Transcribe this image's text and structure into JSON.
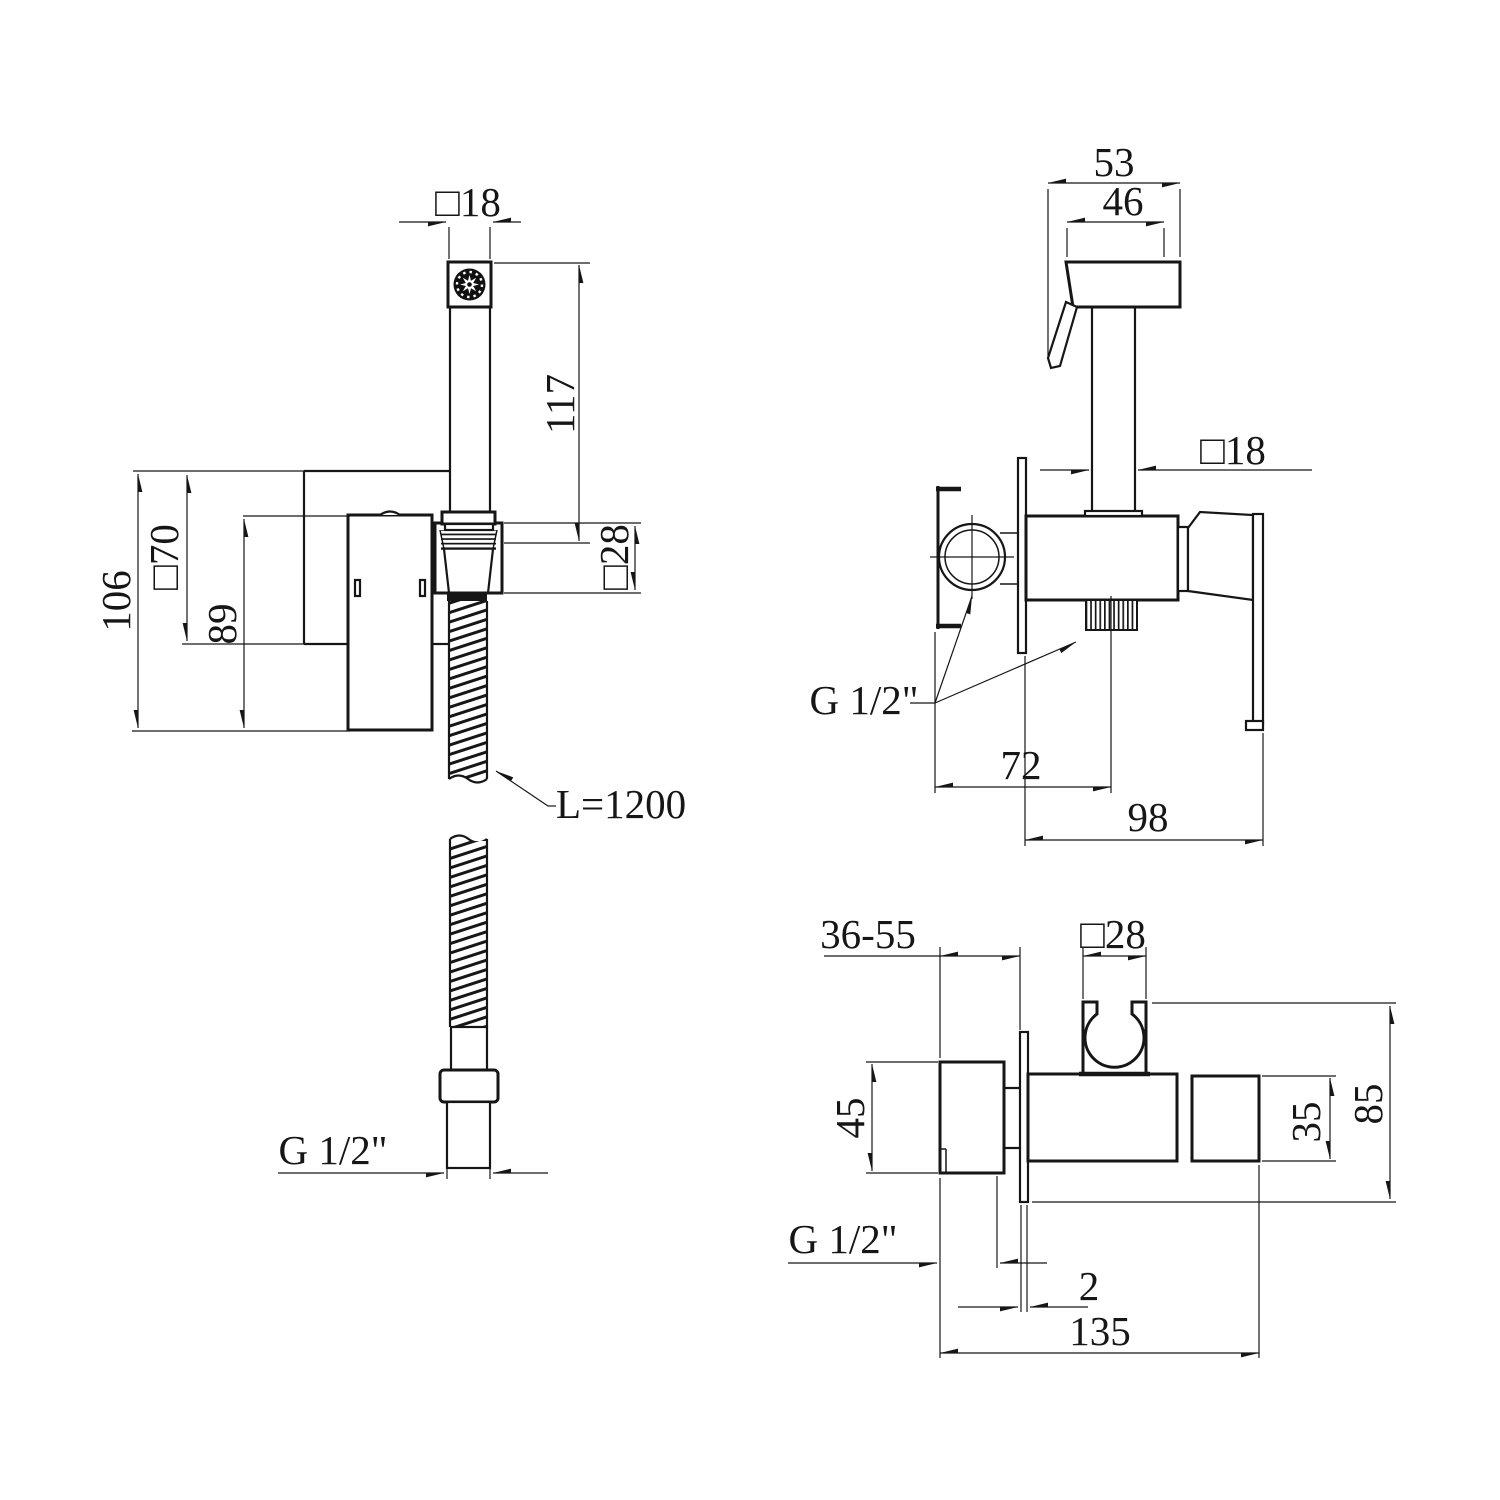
{
  "meta": {
    "background": "#ffffff",
    "line_color": "#161616"
  },
  "views": {
    "front": {
      "labels": {
        "square18": "□18",
        "height117": "117",
        "height106": "106",
        "square70": "□70",
        "height89": "89",
        "square28": "□28",
        "hose_length": "L=1200",
        "thread_size": "G 1/2\""
      }
    },
    "side": {
      "labels": {
        "width53": "53",
        "width46": "46",
        "square18": "□18",
        "thread_size": "G 1/2\"",
        "depth72": "72",
        "width98": "98"
      }
    },
    "top": {
      "labels": {
        "depth_range": "36-55",
        "square28": "□28",
        "height45": "45",
        "height35": "35",
        "height85": "85",
        "thread_size": "G 1/2\"",
        "plate_thickness2": "2",
        "length135": "135"
      }
    }
  }
}
